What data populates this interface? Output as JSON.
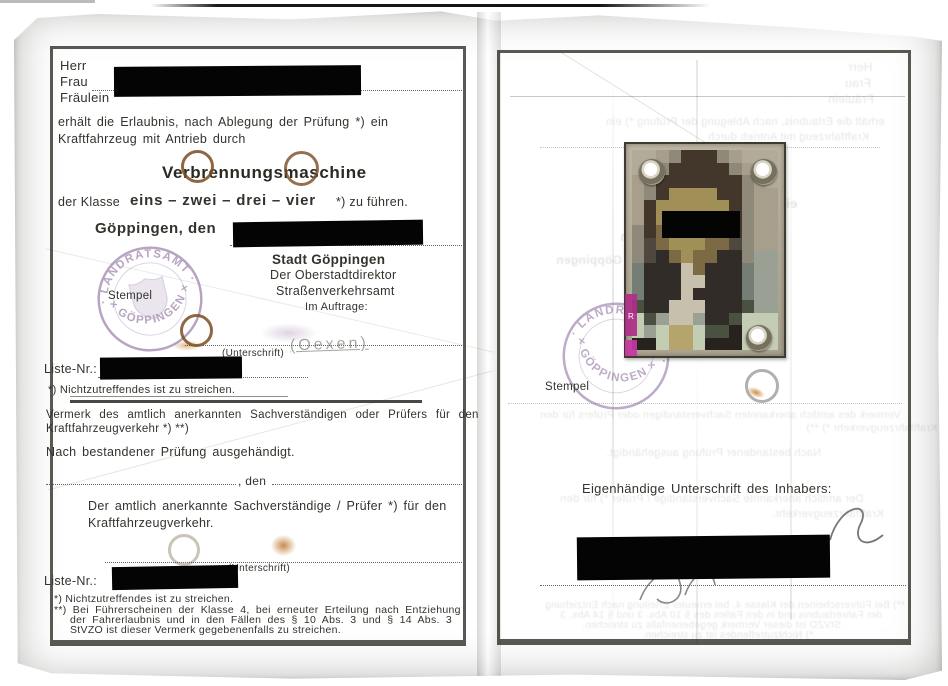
{
  "document_type": "Historical German driving permit (Führerschein), scanned inner pages",
  "left_page": {
    "salutation_1": "Herr",
    "salutation_2": "Frau",
    "salutation_3": "Fräulein",
    "permission_line1": "erhält die Erlaubnis, nach Ablegung der Prüfung *) ein",
    "permission_line2": "Kraftfahrzeug mit Antrieb durch",
    "engine_type": "Verbrennungsmaschine",
    "class_prefix": "der Klasse",
    "class_values": "eins – zwei – drei – vier",
    "class_suffix": "*) zu führen.",
    "place_date_label": "Göppingen, den",
    "authority_line1": "Stadt Göppingen",
    "authority_line2": "Der Oberstadtdirektor",
    "authority_line3": "Straßenverkehrsamt",
    "authority_line4": "Im Auftrage:",
    "stamp_label": "Stempel",
    "signature_caption": "(Unterschrift)",
    "signature_ghost": "(Oexen)",
    "liste_label": "Liste-Nr.:",
    "footnote_strike": "*) Nichtzutreffendes ist zu streichen.",
    "vermerk_line1": "Vermerk des amtlich anerkannten Sachverständigen oder Prüfers für den",
    "vermerk_line2": "Kraftfahrzeugverkehr *) **)",
    "issued_line": "Nach bestandener Prüfung ausgehändigt.",
    "den_label": ", den",
    "examiner_line1": "Der amtlich anerkannte Sachverständige / Prüfer *) für den",
    "examiner_line2": "Kraftfahrzeugverkehr.",
    "signature_caption2": "(Unterschrift)",
    "liste_label2": "Liste-Nr.:",
    "footnote1": "*) Nichtzutreffendes ist zu streichen.",
    "footnote2_line1": "**) Bei Führerscheinen der Klasse 4, bei erneuter Erteilung nach Entziehung",
    "footnote2_line2": "der Fahrerlaubnis und in den Fällen des § 10 Abs. 3 und § 14 Abs. 3",
    "footnote2_line3": "StVZO ist dieser Vermerk gegebenenfalls zu streichen."
  },
  "stamp": {
    "arc_top": "· LANDRATSAMT ·",
    "arc_bottom": "× GÖPPINGEN ×"
  },
  "right_page": {
    "stamp_label": "Stempel",
    "signature_heading": "Eigenhändige Unterschrift des Inhabers:",
    "photo_overlay_letter": "R",
    "photo": {
      "palette": {
        "L": "#b3ab99",
        "l": "#a79e8c",
        "G": "#8f897a",
        "D": "#43362a",
        "B": "#27221d",
        "F": "#a18f58",
        "f": "#b5a46b",
        "O": "#7c6a44",
        "S": "#4e483f",
        "s": "#312c27",
        "W": "#c6c0ad",
        "T": "#757e74",
        "g": "#9ba094",
        "V": "#4a5140",
        "M": "#c2cdb4"
      },
      "rows": [
        "LLlGDDDGlLLL",
        "LlGDDDDDGlLL",
        "lGDDDDDDDGlL",
        "lGDFFFFDDGll",
        "lDFFFFFFDGll",
        "lDFFFFFFDGll",
        "GDOFFFFODGll",
        "GSOFFFOOSGll",
        "GSsOFOOssGgg",
        "TsssWOsssTgg",
        "TsssWWsssTgg",
        "TsssWssssTgg",
        "VssWWWsssVgg",
        "MVgWWgssVMMM",
        "MgMffMVVBMMM",
        "BBMffMBBBMMM"
      ]
    }
  },
  "colors": {
    "paper": "#b5b8ac",
    "ink": "#33322c",
    "frame": "#2b2923",
    "stamp_purple": "#7d5a92",
    "rust": "#8a5a28",
    "magenta": "#b02d8a",
    "redaction": "#000000"
  }
}
